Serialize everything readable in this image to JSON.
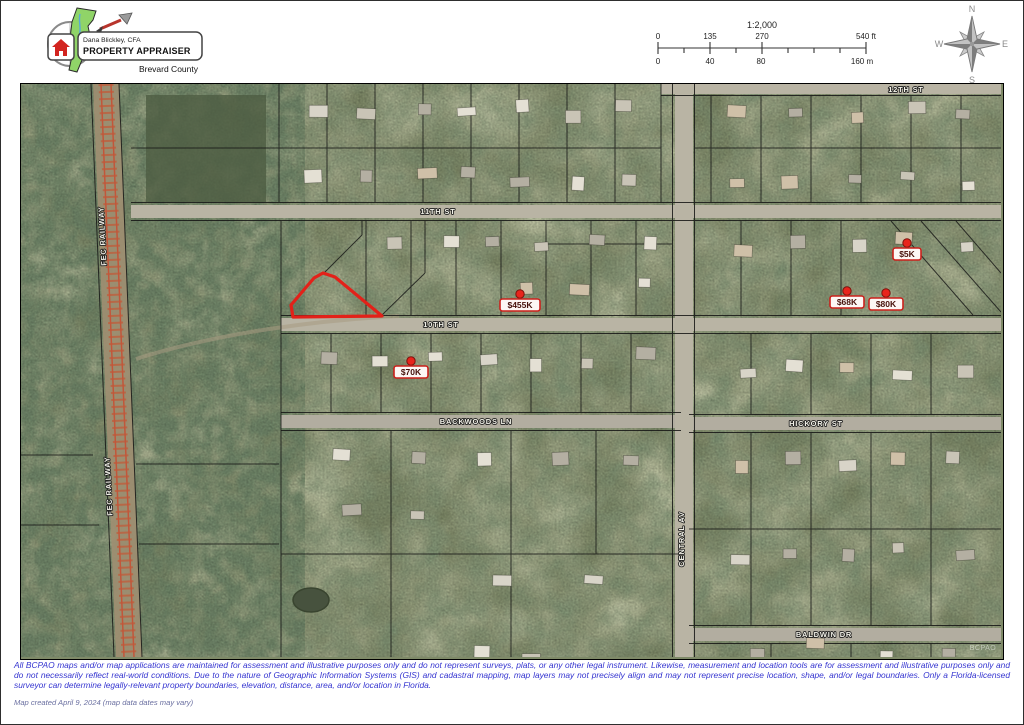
{
  "header": {
    "logo": {
      "name": "Dana Blickley, CFA",
      "title": "PROPERTY APPRAISER",
      "county": "Brevard County"
    },
    "scale": {
      "ratio": "1:2,000",
      "ft_labels": [
        "0",
        "135",
        "270",
        "540 ft"
      ],
      "m_labels": [
        "0",
        "40",
        "80",
        "160 m"
      ]
    },
    "compass": {
      "n": "N",
      "e": "E",
      "s": "S",
      "w": "W"
    }
  },
  "map": {
    "highlight_color": "#e32119",
    "marker_border_color": "#cb201b",
    "watermark": "BCPAO",
    "streets": [
      {
        "label": "12TH ST",
        "x": 885,
        "y": 8,
        "rotate": 0
      },
      {
        "label": "11TH ST",
        "x": 417,
        "y": 130,
        "rotate": 0
      },
      {
        "label": "10TH ST",
        "x": 420,
        "y": 243,
        "rotate": 0
      },
      {
        "label": "BACKWOODS LN",
        "x": 455,
        "y": 340,
        "rotate": 0
      },
      {
        "label": "HICKORY ST",
        "x": 795,
        "y": 342,
        "rotate": 0
      },
      {
        "label": "BALDWIN DR",
        "x": 803,
        "y": 553,
        "rotate": 0
      },
      {
        "label": "CENTRAL AV",
        "x": 663,
        "y": 455,
        "rotate": -90
      },
      {
        "label": "FEC RAILWAY",
        "x": 84,
        "y": 152,
        "rotate": -93
      },
      {
        "label": "FEC RAILWAY",
        "x": 90,
        "y": 402,
        "rotate": -93
      }
    ],
    "markers": [
      {
        "value": "$455K",
        "x": 499,
        "y": 221
      },
      {
        "value": "$70K",
        "x": 390,
        "y": 288
      },
      {
        "value": "$5K",
        "x": 886,
        "y": 170
      },
      {
        "value": "$68K",
        "x": 826,
        "y": 218
      },
      {
        "value": "$80K",
        "x": 865,
        "y": 220
      }
    ]
  },
  "footer": {
    "disclaimer": "All BCPAO maps and/or map applications are maintained for assessment and illustrative purposes only and do not represent surveys, plats, or any other legal instrument. Likewise, measurement and location tools are for assessment and illustrative purposes only and do not necessarily reflect real-world conditions. Due to the nature of Geographic Information Systems (GIS) and cadastral mapping, map layers may not precisely align and may not represent precise location, shape, and/or legal boundaries. Only a Florida-licensed surveyor can determine legally-relevant property boundaries, elevation, distance, area, and/or location in Florida.",
    "created": "Map created April 9, 2024 (map data dates may vary)"
  }
}
